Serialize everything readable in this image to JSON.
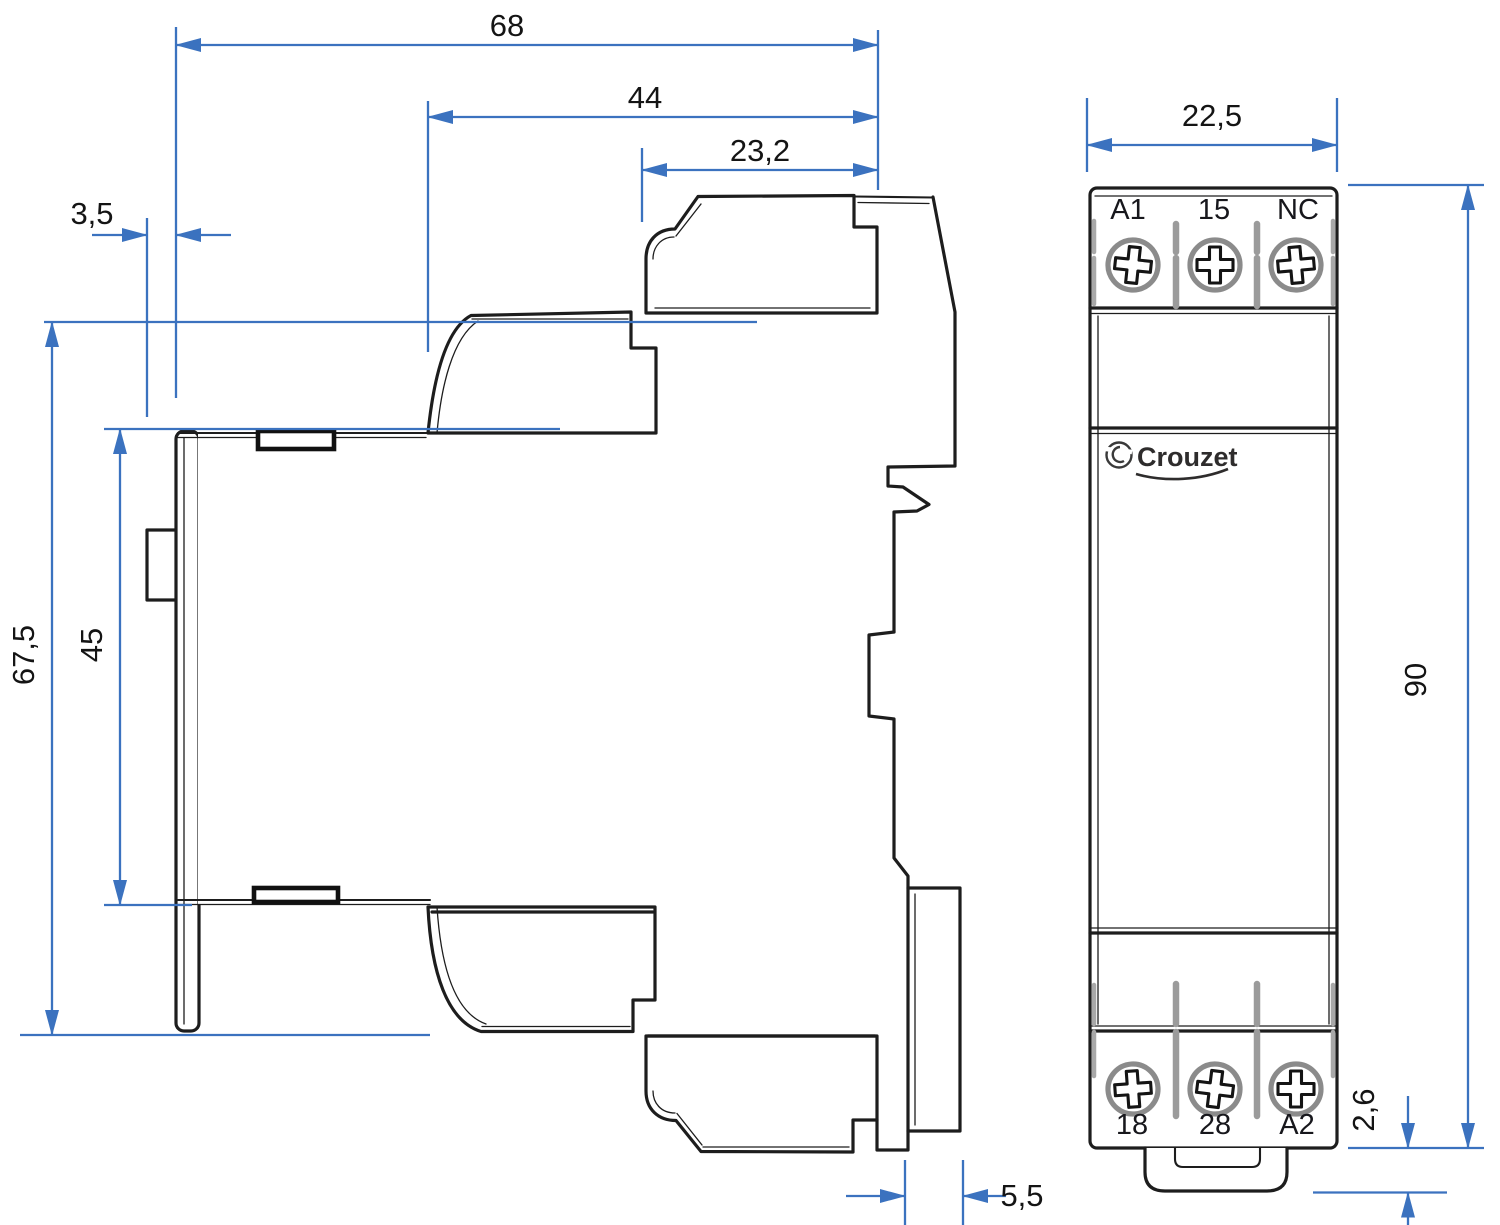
{
  "colors": {
    "dimension_blue": "#3b72bf",
    "drawing_line": "#1d1d1d",
    "screw_gray": "#8b8b8b"
  },
  "side_view": {
    "dims": {
      "overall_depth": "68",
      "mid_depth": "44",
      "front_depth": "23,2",
      "rail_hook_offset": "3,5",
      "rail_seat_height": "45",
      "terminal_span_height": "67,5",
      "foot_depth": "5,5"
    }
  },
  "front_view": {
    "dims": {
      "width": "22,5",
      "height": "90",
      "clip_protrusion": "2,6"
    },
    "top_terminals": [
      "A1",
      "15",
      "NC"
    ],
    "bottom_terminals": [
      "18",
      "28",
      "A2"
    ],
    "brand": "Crouzet"
  }
}
